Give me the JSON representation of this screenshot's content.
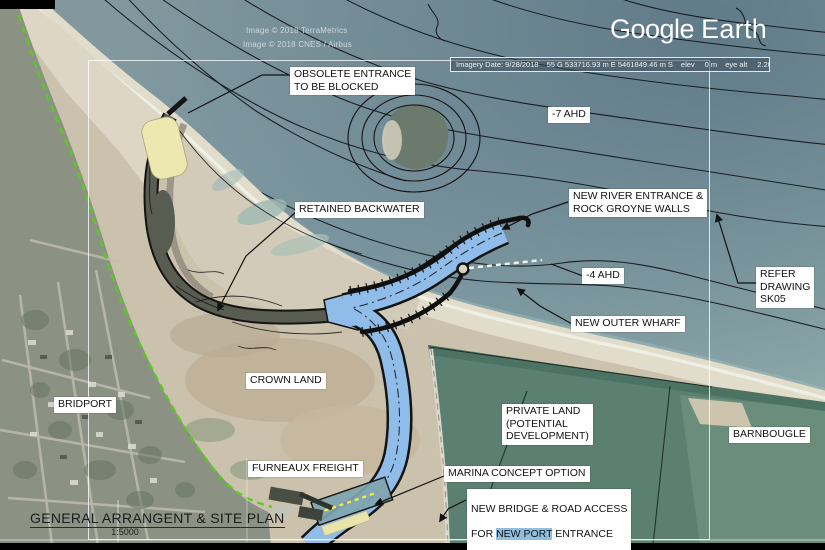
{
  "branding": {
    "google": "Google",
    "earth": "Earth"
  },
  "credits": {
    "line1": "Image © 2018 TerraMetrics",
    "line2": "Image © 2018 CNES / Airbus"
  },
  "status_bar": {
    "imagery_date": "Imagery Date: 9/28/2018",
    "utm_coordinates": "55 G 533716.93 m E 5461849.46 m S",
    "elev_label": "elev",
    "elev_value": "0 m",
    "eye_alt_label": "eye alt",
    "eye_alt_value": "2.20 km",
    "compass_icon": "north-compass-circle"
  },
  "annotations": {
    "obsolete_entrance": "OBSOLETE ENTRANCE\nTO BE BLOCKED",
    "depth_minus7": "-7 AHD",
    "retained_backwater": "RETAINED BACKWATER",
    "new_river_entrance": "NEW RIVER ENTRANCE &\nROCK GROYNE WALLS",
    "depth_minus4": "-4 AHD",
    "refer_drawing": "REFER\nDRAWING\nSK05",
    "new_outer_wharf": "NEW OUTER WHARF",
    "crown_land": "CROWN LAND",
    "bridport": "BRIDPORT",
    "private_land": "PRIVATE LAND\n(POTENTIAL\nDEVELOPMENT)",
    "barnbougle": "BARNBOUGLE",
    "furneaux_freight": "FURNEAUX FREIGHT",
    "marina_concept": "MARINA CONCEPT OPTION",
    "new_bridge_line1": "NEW BRIDGE & ROAD ACCESS",
    "new_bridge_line2_pre": "FOR ",
    "new_bridge_highlight": "NEW PORT",
    "new_bridge_line2_post": " ENTRANCE"
  },
  "title_block": {
    "title": "GENERAL ARRANGENT & SITE PLAN",
    "scale": "1:5000"
  },
  "colors": {
    "sea": "#7f98a0",
    "sand": "#cbc2ad",
    "beach": "#e2dcca",
    "town": "#8b9183",
    "fields": "#5b8071",
    "channel_blue": "#8fbce8",
    "annotation_yellow": "#ece8b0",
    "coast_green_dash": "#58cc1e",
    "label_bg": "#ffffff",
    "highlight_blue": "#92bede",
    "contour_black": "#101418"
  }
}
